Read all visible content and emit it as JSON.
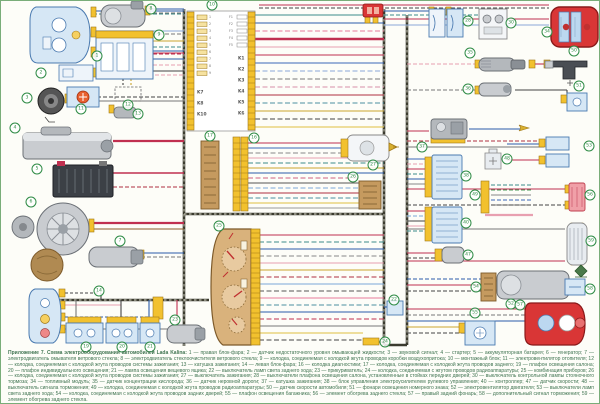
{
  "title": "Схема электрооборудования автомобилей Lada Kalina",
  "palette": {
    "bus": "#3b3b2f",
    "connector_yellow": "#f2c12e",
    "connector_border": "#a07818",
    "component_blue_fill": "#d6e7f5",
    "component_blue_border": "#4a7ab0",
    "silver": "#c9ccd0",
    "brown": "#c59a5f",
    "brown_border": "#7d5a2a",
    "red_component": "#d93636",
    "badge_green": "#2e8b45",
    "caption_green": "#417552",
    "wire_red": "#c03050",
    "wire_pink": "#e8a0b0",
    "wire_rose": "#e87a9a",
    "wire_blue": "#2a5caa",
    "wire_lightblue": "#8aa8d8",
    "wire_teal": "#3a8a8a",
    "wire_yellow": "#caa52e",
    "wire_gray": "#777777",
    "wire_black": "#444444",
    "wire_maroon": "#b03040"
  },
  "junction_block": {
    "badge": "10",
    "relays_right": [
      "K1",
      "K2",
      "K3",
      "K4",
      "K5",
      "K6"
    ],
    "relays_left": [
      "K7",
      "K8",
      "K10"
    ],
    "fuses_right": [
      "F1",
      "F2",
      "F3",
      "F4",
      "F5"
    ],
    "fuse_rows_left": [
      "1",
      "2",
      "3",
      "4",
      "5",
      "6",
      "7",
      "8",
      "9"
    ]
  },
  "component_badges": [
    {
      "n": "1",
      "x": 96,
      "y": 55
    },
    {
      "n": "2",
      "x": 40,
      "y": 72
    },
    {
      "n": "3",
      "x": 26,
      "y": 97
    },
    {
      "n": "4",
      "x": 14,
      "y": 127
    },
    {
      "n": "5",
      "x": 36,
      "y": 168
    },
    {
      "n": "6",
      "x": 30,
      "y": 201
    },
    {
      "n": "7",
      "x": 119,
      "y": 240
    },
    {
      "n": "8",
      "x": 150,
      "y": 8
    },
    {
      "n": "9",
      "x": 158,
      "y": 34
    },
    {
      "n": "10",
      "x": 211,
      "y": 4
    },
    {
      "n": "11",
      "x": 80,
      "y": 108
    },
    {
      "n": "12",
      "x": 127,
      "y": 104
    },
    {
      "n": "13",
      "x": 137,
      "y": 113
    },
    {
      "n": "14",
      "x": 98,
      "y": 290
    },
    {
      "n": "16",
      "x": 253,
      "y": 137
    },
    {
      "n": "17",
      "x": 209,
      "y": 135
    },
    {
      "n": "19",
      "x": 85,
      "y": 346
    },
    {
      "n": "20",
      "x": 121,
      "y": 346
    },
    {
      "n": "21",
      "x": 149,
      "y": 346
    },
    {
      "n": "22",
      "x": 393,
      "y": 299
    },
    {
      "n": "23",
      "x": 174,
      "y": 319
    },
    {
      "n": "24",
      "x": 384,
      "y": 341
    },
    {
      "n": "25",
      "x": 218,
      "y": 225
    },
    {
      "n": "26",
      "x": 352,
      "y": 176
    },
    {
      "n": "27",
      "x": 372,
      "y": 164
    },
    {
      "n": "28",
      "x": 467,
      "y": 20
    },
    {
      "n": "30",
      "x": 510,
      "y": 22
    },
    {
      "n": "34",
      "x": 546,
      "y": 31
    },
    {
      "n": "35",
      "x": 469,
      "y": 52
    },
    {
      "n": "36",
      "x": 467,
      "y": 88
    },
    {
      "n": "37",
      "x": 421,
      "y": 146
    },
    {
      "n": "38",
      "x": 465,
      "y": 175
    },
    {
      "n": "40",
      "x": 465,
      "y": 222
    },
    {
      "n": "47",
      "x": 467,
      "y": 254
    },
    {
      "n": "48",
      "x": 506,
      "y": 158
    },
    {
      "n": "49",
      "x": 474,
      "y": 194
    },
    {
      "n": "50",
      "x": 573,
      "y": 50
    },
    {
      "n": "51",
      "x": 578,
      "y": 85
    },
    {
      "n": "52",
      "x": 510,
      "y": 303
    },
    {
      "n": "53",
      "x": 588,
      "y": 145
    },
    {
      "n": "54",
      "x": 475,
      "y": 286
    },
    {
      "n": "55",
      "x": 474,
      "y": 312
    },
    {
      "n": "56",
      "x": 589,
      "y": 194
    },
    {
      "n": "57",
      "x": 519,
      "y": 304
    },
    {
      "n": "58",
      "x": 589,
      "y": 288
    },
    {
      "n": "59",
      "x": 590,
      "y": 240
    }
  ],
  "caption": {
    "legend_lead": "Приложение 7. Схема электрооборудования автомобилей Lada Kalina:",
    "legend_body": " 1 — правая блок-фара; 2 — датчик недостаточного уровня омывающей жидкости; 3 — звуковой сигнал; 4 — стартер; 5 — аккумуляторная батарея; 6 — генератор; 7 — электродвигатель омывателя ветрового стекла; 8 — электродвигатель стеклоочистителя ветрового стекла; 9 — колодка, соединяемая с колодкой жгута проводов коробки воздухопритока; 10 — монтажный блок; 11 — электровентилятор отопителя; 12 — колодка, соединяемая с колодкой жгута проводов системы зажигания; 13 — катушка зажигания; 14 — левая блок-фара; 16 — колодка диагностики; 17 — колодка, соединяемая с колодкой жгута проводов заднего; 19 — плафон освещения салона; 20 — плафон индивидуального освещения; 21 — лампа освещения вещевого ящика; 22 — выключатель ламп света заднего хода; 23 — прикуриватель; 24 — колодка, соединяемая с жгутом проводов радиоаппаратуры; 25 — комбинация приборов; 26 — колодка, соединяемая с колодкой жгута проводов системы зажигания; 27 — выключатель зажигания; 28 — выключатели плафона освещения салона, установленные в стойках передних дверей; 30 — выключатель контрольной лампы стояночного тормоза; 34 — топливный модуль; 35 — датчик концентрации кислорода; 36 — датчик неровной дороги; 37 — катушка зажигания; 38 — блок управления электроусилителем рулевого управления; 40 — контроллер; 47 — датчик скорости; 48 — выключатель сигнала торможения; 49 — колодка, соединяемая с колодкой жгута проводов радиоаппаратуры; 50 — датчик скорости автомобиля; 51 — фонари освещения номерного знака; 52 — электровентилятор двигателя; 53 — выключатели ламп света заднего хода; 54 — колодка, соединяемая с колодкой жгута проводов задних дверей; 55 — плафон освещения багажника; 56 — элемент обогрева заднего стекла; 57 — правый задний фонарь; 58 — дополнительный сигнал торможения; 59 — элемент обогрева заднего стекла.",
    "note": "Провода на схеме обозначены в соответствии с расцветкой изоляции в жгутах проводов. Наряду с буквенным обозначением цвета провода применяется и цифровое обозначение. Для двухцветных проводов первым указано обозначение основного цвета изоляции, вторым — цвет полосы. Нумерация выводов в колодках соответствует нумерации, нанесённой на колодках жгутов проводов (см. приложения 8–11)."
  }
}
